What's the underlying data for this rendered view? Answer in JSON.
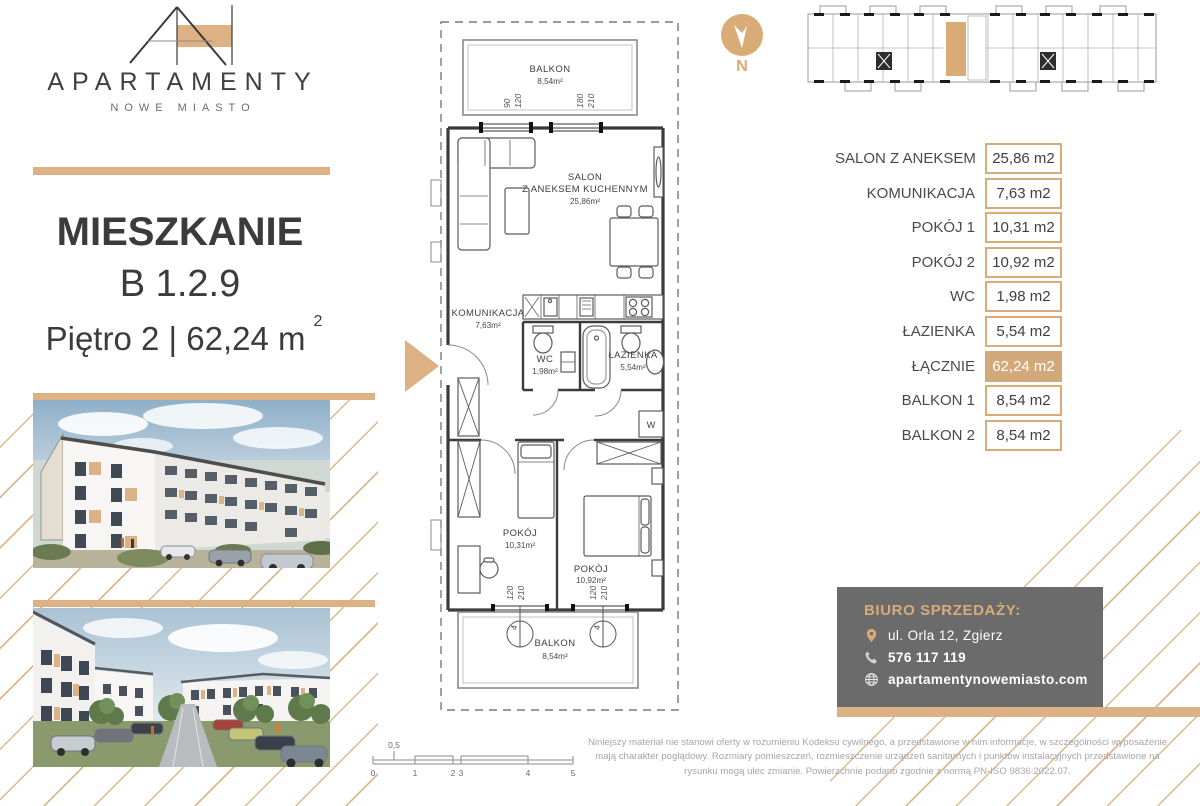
{
  "brand": {
    "name": "APARTAMENTY",
    "sub": "NOWE MIASTO"
  },
  "title": {
    "label": "MIESZKANIE",
    "unit": "B 1.2.9",
    "floor": "Piętro 2 | 62,24 m",
    "sup": "2"
  },
  "compass": {
    "label": "N"
  },
  "plan": {
    "balkon_top": {
      "name": "BALKON",
      "area": "8,54m²"
    },
    "salon": {
      "name1": "SALON",
      "name2": "Z ANEKSEM KUCHENNYM",
      "area": "25,86m²"
    },
    "komunikacja": {
      "name": "KOMUNIKACJA",
      "area": "7,63m²"
    },
    "wc": {
      "name": "WC",
      "area": "1,98m²"
    },
    "lazienka": {
      "name": "ŁAZIENKA",
      "area": "5,54m²"
    },
    "pokoj1": {
      "name": "POKÓJ",
      "area": "10,31m²"
    },
    "pokoj2": {
      "name": "POKÓJ",
      "area": "10,92m²"
    },
    "balkon_bottom": {
      "name": "BALKON",
      "area": "8,54m²"
    },
    "washer": "W",
    "dims": {
      "t1a": "90",
      "t1b": "120",
      "t2a": "180",
      "t2b": "210",
      "b1a": "120",
      "b1b": "210",
      "b2a": "120",
      "b2b": "210",
      "c1": "4",
      "c2": "4"
    }
  },
  "scalebar": {
    "labels": [
      "0",
      "1",
      "2",
      "3",
      "4",
      "5"
    ],
    "half": "0,5"
  },
  "table": {
    "rows": [
      {
        "label": "SALON Z ANEKSEM",
        "value": "25,86 m2"
      },
      {
        "label": "KOMUNIKACJA",
        "value": "7,63 m2"
      },
      {
        "label": "POKÓJ 1",
        "value": "10,31 m2"
      },
      {
        "label": "POKÓJ 2",
        "value": "10,92 m2"
      },
      {
        "label": "WC",
        "value": "1,98 m2"
      },
      {
        "label": "ŁAZIENKA",
        "value": "5,54 m2"
      },
      {
        "label": "ŁĄCZNIE",
        "value": "62,24 m2"
      },
      {
        "label": "BALKON 1",
        "value": "8,54 m2"
      },
      {
        "label": "BALKON 2",
        "value": "8,54 m2"
      }
    ]
  },
  "sales": {
    "heading": "BIURO SPRZEDAŻY:",
    "address": "ul. Orla 12, Zgierz",
    "phone": "576 117 119",
    "website": "apartamentynowemiasto.com"
  },
  "disclaimer": "Niniejszy materiał nie stanowi oferty w rozumieniu Kodeksu cywilnego, a przedstawione w nim informacje, w szczególności wyposażenie mają charakter poglądowy. Rozmiary pomieszczeń, rozmieszczenie urządzeń sanitarnych i punktów instalacyjnych przedstawione na rysunku mogą ulec zmianie. Powierzchnie podano zgodnie z normą PN-ISO 9836:2022.07.",
  "colors": {
    "accent": "#d9ab77",
    "bar": "#dcb183",
    "dark_box": "#6b6b6b",
    "highlight_cell": "#d3a97b"
  }
}
